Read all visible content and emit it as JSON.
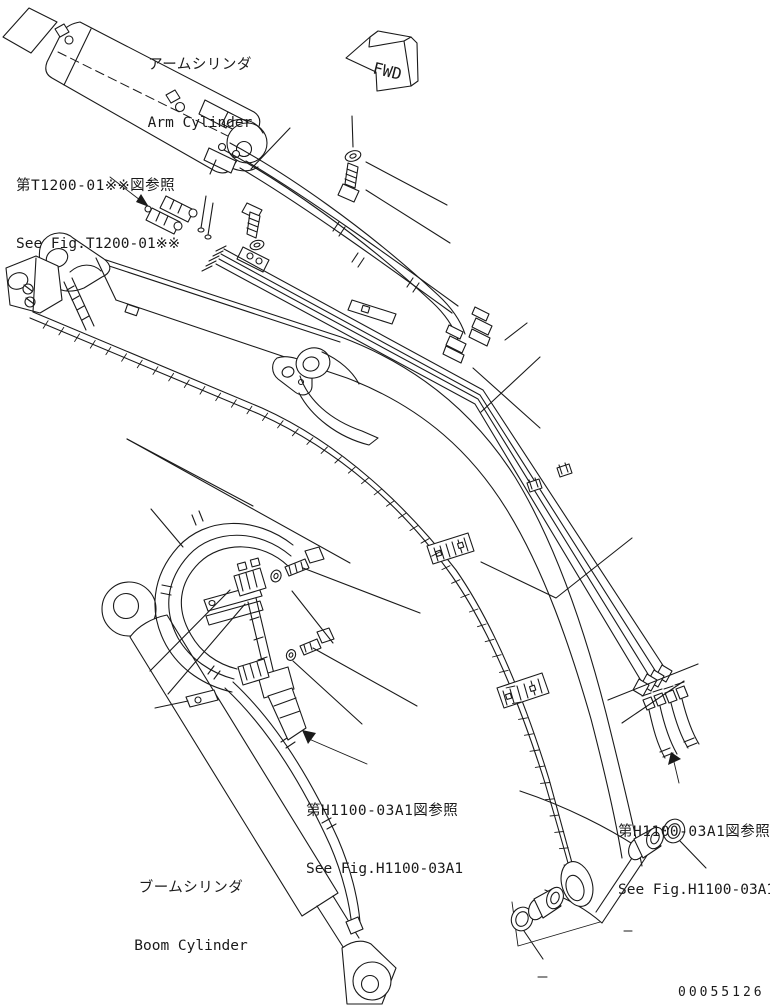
{
  "labels": {
    "arm_cylinder": {
      "jp": "アームシリンダ",
      "en": "Arm Cylinder"
    },
    "boom_cylinder": {
      "jp": "ブームシリンダ",
      "en": "Boom Cylinder"
    },
    "ref_t1200": {
      "jp": "第T1200-01※※図参照",
      "en": "See Fig.T1200-01※※"
    },
    "ref_h1100_center": {
      "jp": "第H1100-03A1図参照",
      "en": "See Fig.H1100-03A1"
    },
    "ref_h1100_right": {
      "jp": "第H1100-03A1図参照",
      "en": "See Fig.H1100-03A1"
    },
    "fwd": "FWD",
    "part_number": "00055126"
  },
  "colors": {
    "line": "#1a1a1a",
    "background": "#ffffff"
  }
}
